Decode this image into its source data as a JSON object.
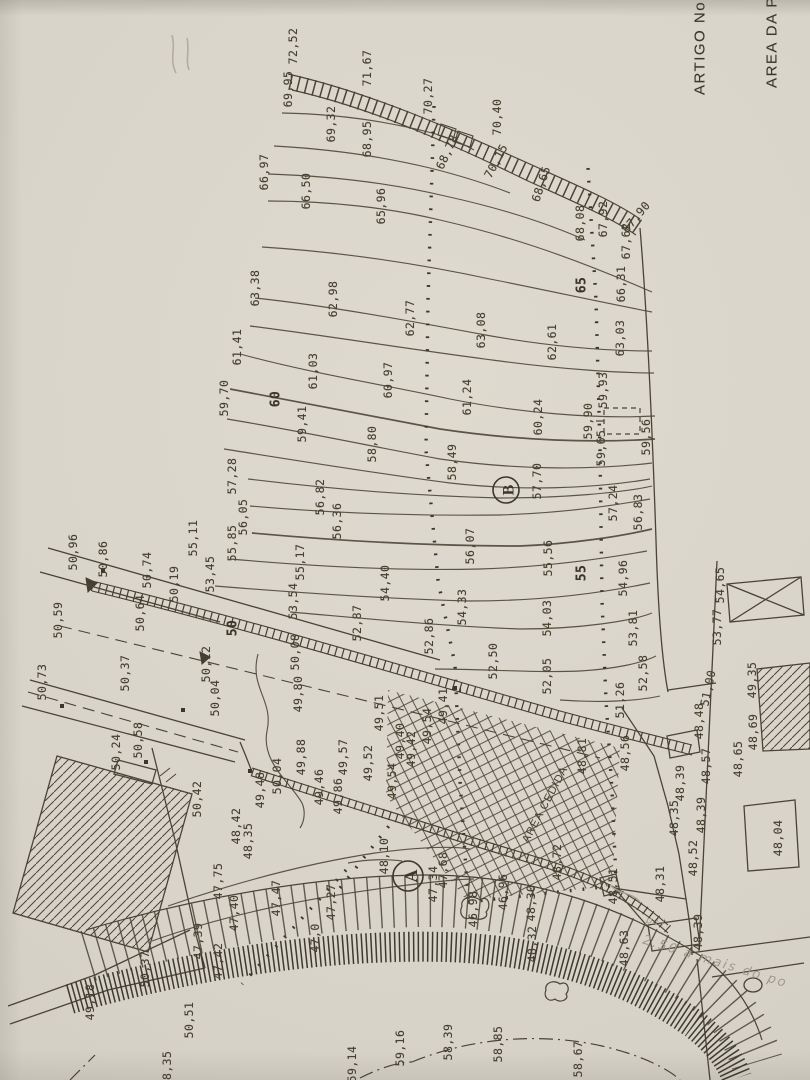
{
  "texts": {
    "artigo": "ARTIGO No",
    "area_da": "AREA DA P",
    "area_cedida": "AREA CEDIDA",
    "note": "2,50 a mais do po",
    "note_small": "p.i.i"
  },
  "sections": {
    "a": "A",
    "b": "B"
  },
  "colors": {
    "paper": "#d8d4ca",
    "ink": "#4a4436",
    "pencil": "#a09a8c"
  },
  "elevation_labels": [
    {
      "t": "72,52",
      "x": 293,
      "y": 46
    },
    {
      "t": "69,95",
      "x": 288,
      "y": 89
    },
    {
      "t": "71,67",
      "x": 367,
      "y": 68
    },
    {
      "t": "70,27",
      "x": 428,
      "y": 96
    },
    {
      "t": "69,32",
      "x": 331,
      "y": 124
    },
    {
      "t": "68,95",
      "x": 367,
      "y": 139
    },
    {
      "t": "68,78",
      "x": 447,
      "y": 152,
      "r": -65
    },
    {
      "t": "70,40",
      "x": 497,
      "y": 117
    },
    {
      "t": "70,15",
      "x": 496,
      "y": 161,
      "r": -62
    },
    {
      "t": "66,97",
      "x": 264,
      "y": 172
    },
    {
      "t": "66,50",
      "x": 306,
      "y": 191
    },
    {
      "t": "65,96",
      "x": 381,
      "y": 206
    },
    {
      "t": "68,65",
      "x": 541,
      "y": 184,
      "r": -72
    },
    {
      "t": "68,08",
      "x": 580,
      "y": 223
    },
    {
      "t": "67,92",
      "x": 603,
      "y": 219
    },
    {
      "t": "67,90",
      "x": 636,
      "y": 217,
      "r": -50
    },
    {
      "t": "67,62",
      "x": 626,
      "y": 241
    },
    {
      "t": "66,31",
      "x": 621,
      "y": 284
    },
    {
      "t": "65",
      "x": 582,
      "y": 285,
      "b": 1
    },
    {
      "t": "63,38",
      "x": 255,
      "y": 288
    },
    {
      "t": "62,98",
      "x": 333,
      "y": 299
    },
    {
      "t": "62,77",
      "x": 410,
      "y": 318
    },
    {
      "t": "63,08",
      "x": 481,
      "y": 330
    },
    {
      "t": "62,61",
      "x": 552,
      "y": 342
    },
    {
      "t": "63,03",
      "x": 620,
      "y": 338
    },
    {
      "t": "61,41",
      "x": 237,
      "y": 347
    },
    {
      "t": "61,03",
      "x": 313,
      "y": 371
    },
    {
      "t": "60,97",
      "x": 388,
      "y": 380
    },
    {
      "t": "61,24",
      "x": 467,
      "y": 397
    },
    {
      "t": "59,70",
      "x": 224,
      "y": 398
    },
    {
      "t": "60",
      "x": 276,
      "y": 399,
      "b": 1
    },
    {
      "t": "59,41",
      "x": 302,
      "y": 424
    },
    {
      "t": "58,80",
      "x": 372,
      "y": 444
    },
    {
      "t": "60,24",
      "x": 538,
      "y": 417
    },
    {
      "t": "59,93",
      "x": 603,
      "y": 390
    },
    {
      "t": "59,90",
      "x": 588,
      "y": 421
    },
    {
      "t": "59,65",
      "x": 601,
      "y": 448
    },
    {
      "t": "59,56",
      "x": 646,
      "y": 437
    },
    {
      "t": "58,49",
      "x": 452,
      "y": 462
    },
    {
      "t": "57,28",
      "x": 232,
      "y": 476
    },
    {
      "t": "56,82",
      "x": 320,
      "y": 497
    },
    {
      "t": "57,70",
      "x": 537,
      "y": 481
    },
    {
      "t": "57,24",
      "x": 613,
      "y": 503
    },
    {
      "t": "56,83",
      "x": 638,
      "y": 512
    },
    {
      "t": "56,05",
      "x": 243,
      "y": 517
    },
    {
      "t": "55,85",
      "x": 232,
      "y": 543
    },
    {
      "t": "55,11",
      "x": 193,
      "y": 538
    },
    {
      "t": "56,36",
      "x": 337,
      "y": 521
    },
    {
      "t": "56,07",
      "x": 470,
      "y": 546
    },
    {
      "t": "55,56",
      "x": 548,
      "y": 558
    },
    {
      "t": "55",
      "x": 582,
      "y": 573,
      "b": 1
    },
    {
      "t": "54,96",
      "x": 623,
      "y": 578
    },
    {
      "t": "53,45",
      "x": 210,
      "y": 574
    },
    {
      "t": "55,17",
      "x": 300,
      "y": 562
    },
    {
      "t": "54,40",
      "x": 385,
      "y": 583
    },
    {
      "t": "53,54",
      "x": 293,
      "y": 601
    },
    {
      "t": "54,33",
      "x": 462,
      "y": 607
    },
    {
      "t": "54,03",
      "x": 547,
      "y": 618
    },
    {
      "t": "53,81",
      "x": 633,
      "y": 628
    },
    {
      "t": "52,87",
      "x": 357,
      "y": 623
    },
    {
      "t": "52,86",
      "x": 429,
      "y": 636
    },
    {
      "t": "52,50",
      "x": 493,
      "y": 661
    },
    {
      "t": "52,05",
      "x": 547,
      "y": 676
    },
    {
      "t": "52,58",
      "x": 643,
      "y": 673
    },
    {
      "t": "51,26",
      "x": 620,
      "y": 700
    },
    {
      "t": "51,00",
      "x": 708,
      "y": 688,
      "r": -78
    },
    {
      "t": "50,96",
      "x": 73,
      "y": 552
    },
    {
      "t": "50,86",
      "x": 103,
      "y": 559
    },
    {
      "t": "50,74",
      "x": 147,
      "y": 570
    },
    {
      "t": "50,19",
      "x": 174,
      "y": 584
    },
    {
      "t": "50,64",
      "x": 140,
      "y": 613
    },
    {
      "t": "50,59",
      "x": 58,
      "y": 620
    },
    {
      "t": "50,37",
      "x": 125,
      "y": 673
    },
    {
      "t": "50,73",
      "x": 42,
      "y": 682
    },
    {
      "t": "50,12",
      "x": 206,
      "y": 664
    },
    {
      "t": "50,04",
      "x": 215,
      "y": 698
    },
    {
      "t": "50,08",
      "x": 295,
      "y": 652
    },
    {
      "t": "50",
      "x": 233,
      "y": 628,
      "b": 1
    },
    {
      "t": "49,80",
      "x": 298,
      "y": 694
    },
    {
      "t": "50,24",
      "x": 116,
      "y": 752
    },
    {
      "t": "50,58",
      "x": 138,
      "y": 740
    },
    {
      "t": "49,51",
      "x": 379,
      "y": 713
    },
    {
      "t": "49,41",
      "x": 443,
      "y": 706
    },
    {
      "t": "49,54",
      "x": 427,
      "y": 726
    },
    {
      "t": "49,40",
      "x": 400,
      "y": 741
    },
    {
      "t": "49,42",
      "x": 411,
      "y": 749
    },
    {
      "t": "49,88",
      "x": 301,
      "y": 757
    },
    {
      "t": "49,57",
      "x": 343,
      "y": 757
    },
    {
      "t": "49,52",
      "x": 368,
      "y": 763
    },
    {
      "t": "49,54",
      "x": 392,
      "y": 781
    },
    {
      "t": "49,48",
      "x": 260,
      "y": 790
    },
    {
      "t": "49,46",
      "x": 319,
      "y": 787
    },
    {
      "t": "49,86",
      "x": 338,
      "y": 796
    },
    {
      "t": "50,04",
      "x": 277,
      "y": 776
    },
    {
      "t": "48,42",
      "x": 236,
      "y": 826
    },
    {
      "t": "48,35",
      "x": 248,
      "y": 841
    },
    {
      "t": "50,42",
      "x": 197,
      "y": 799
    },
    {
      "t": "47,75",
      "x": 218,
      "y": 881
    },
    {
      "t": "47,40",
      "x": 234,
      "y": 913
    },
    {
      "t": "47,39",
      "x": 198,
      "y": 941
    },
    {
      "t": "47,42",
      "x": 218,
      "y": 961
    },
    {
      "t": "47,47",
      "x": 276,
      "y": 898
    },
    {
      "t": "47,34",
      "x": 433,
      "y": 884
    },
    {
      "t": "47,68",
      "x": 443,
      "y": 870
    },
    {
      "t": "48,10",
      "x": 384,
      "y": 856
    },
    {
      "t": "47,27",
      "x": 331,
      "y": 902
    },
    {
      "t": "47,0",
      "x": 315,
      "y": 938
    },
    {
      "t": "46,96",
      "x": 503,
      "y": 892
    },
    {
      "t": "46,98",
      "x": 473,
      "y": 909
    },
    {
      "t": "48,30",
      "x": 531,
      "y": 903
    },
    {
      "t": "48,32",
      "x": 532,
      "y": 944
    },
    {
      "t": "48,56",
      "x": 625,
      "y": 753
    },
    {
      "t": "48,81",
      "x": 582,
      "y": 756
    },
    {
      "t": "48,72",
      "x": 557,
      "y": 862
    },
    {
      "t": "48,51",
      "x": 613,
      "y": 886
    },
    {
      "t": "48,63",
      "x": 624,
      "y": 948
    },
    {
      "t": "48,39",
      "x": 698,
      "y": 932
    },
    {
      "t": "48,31",
      "x": 660,
      "y": 884
    },
    {
      "t": "48,52",
      "x": 693,
      "y": 858
    },
    {
      "t": "48,35",
      "x": 674,
      "y": 818
    },
    {
      "t": "48,39",
      "x": 701,
      "y": 815
    },
    {
      "t": "48,39",
      "x": 680,
      "y": 783
    },
    {
      "t": "48,57",
      "x": 706,
      "y": 766
    },
    {
      "t": "48,48",
      "x": 699,
      "y": 721
    },
    {
      "t": "49,35",
      "x": 752,
      "y": 680
    },
    {
      "t": "48,69",
      "x": 753,
      "y": 732
    },
    {
      "t": "48,65",
      "x": 738,
      "y": 759
    },
    {
      "t": "48,04",
      "x": 778,
      "y": 838
    },
    {
      "t": "53,77",
      "x": 717,
      "y": 627
    },
    {
      "t": "54,65",
      "x": 720,
      "y": 585
    },
    {
      "t": "49,18",
      "x": 90,
      "y": 1002
    },
    {
      "t": "50,37",
      "x": 145,
      "y": 969
    },
    {
      "t": "50,51",
      "x": 189,
      "y": 1020
    },
    {
      "t": "58,39",
      "x": 448,
      "y": 1042
    },
    {
      "t": "58,85",
      "x": 498,
      "y": 1044
    },
    {
      "t": "58,67",
      "x": 578,
      "y": 1059
    },
    {
      "t": "59,16",
      "x": 400,
      "y": 1048
    },
    {
      "t": "59,14",
      "x": 352,
      "y": 1064
    },
    {
      "t": "58,35",
      "x": 167,
      "y": 1069
    }
  ]
}
